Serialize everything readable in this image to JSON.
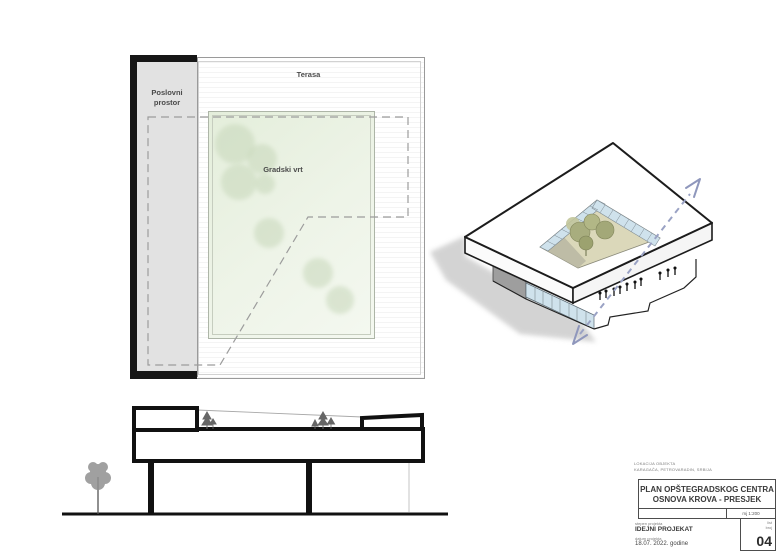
{
  "roof_plan": {
    "business_space_label": "Poslovni\nprostor",
    "terrace_label": "Terasa",
    "garden_label": "Gradski vrt"
  },
  "title_block": {
    "location_label": "LOKACIJA OBJEKTA",
    "location_value": "KARAGAČA, PETROVARADIN, SRBIJA",
    "title_line1": "PLAN OPŠTEGRADSKOG CENTRA",
    "title_line2": "OSNOVA KROVA - PRESJEK",
    "scale": "mj 1:200",
    "stage_label": "stepen projekta",
    "stage_value": "IDEJNI PROJEKAT",
    "date_label": "datum projekta",
    "date_value": "18.07. 2022. godine",
    "sheet_label": "list\nbroj",
    "sheet_number": "04"
  },
  "colors": {
    "paper": "#ffffff",
    "ink": "#1a1a1a",
    "garden_green": "#e9f1e1",
    "tree_green": "#c7d7ba",
    "strip_gray": "#e2e2e2",
    "glass_blue": "#cfe2ec",
    "courtyard_floor": "#dbd8ba",
    "courtyard_tree": "#a8ad7e",
    "arrow_blue": "#98a0c4",
    "shadow_gray": "#c9c9c9",
    "dashed_gray": "#9c9c9c"
  }
}
